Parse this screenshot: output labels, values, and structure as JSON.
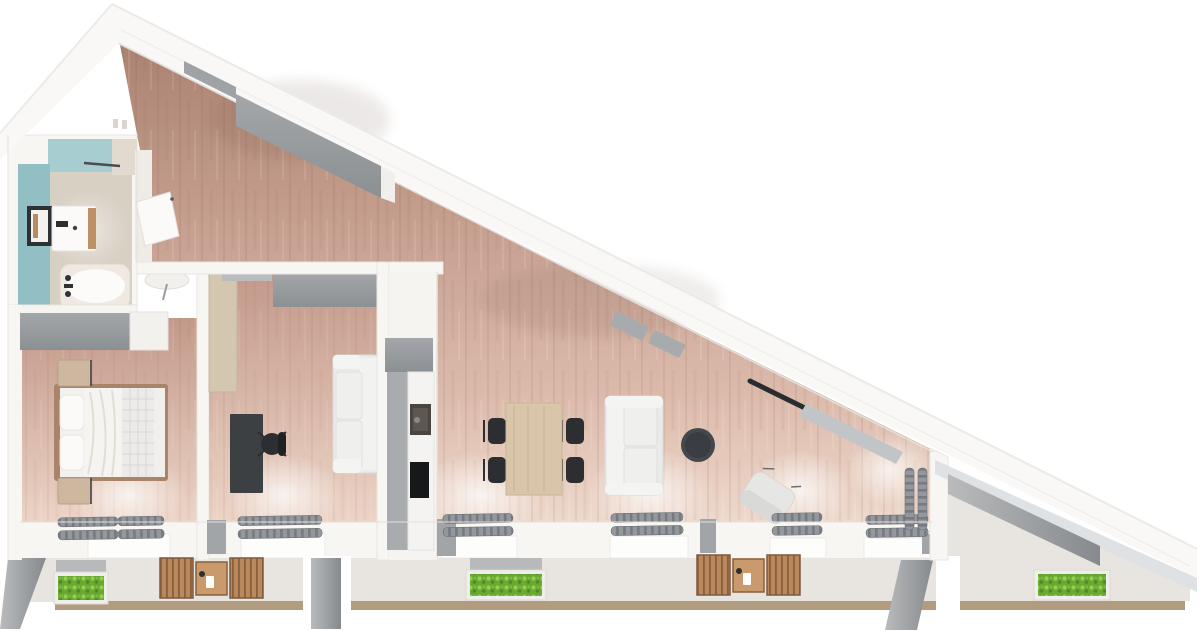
{
  "meta": {
    "kind": "3d-floor-plan-render",
    "view": "top-down",
    "shape": "right-triangle apartment, hypotenuse roof edge from top-left apex to bottom-right tip"
  },
  "colors": {
    "pageBg": "#ffffff",
    "wallWhite": "#f8f6f3",
    "wallEdge": "#e6e3df",
    "tealWallTop": "#a8cdd0",
    "tealWallSide": "#92bfc4",
    "bathFloor": "#d9d0c4",
    "bathEntryFloor": "#e2dacf",
    "furnitureGray": "#989c9f",
    "cabinetGray": "#9aa0a3",
    "stubGray": "#a2a5a7",
    "balconyFloor": "#e8e5e0",
    "balconyEdgeTan": "#b29c80",
    "plantGreen": "#6aa834",
    "patioWood": "#b9885c",
    "patioTableWood": "#c89a6c",
    "sofaWhite": "#eaeaea",
    "sofaShade": "#dcdcdc",
    "deskBlack": "#3c4043",
    "chairBlack": "#2c2e31",
    "diningWood": "#d8c5aa",
    "coffeeTableDark": "#45484d",
    "doorTan": "#d3c7b0",
    "doorWhite": "#fbfaf8",
    "bedFrame": "#a9846b",
    "beddingWhite": "#f6f4f1",
    "quiltGray": "#ecebe9",
    "nightstandTan": "#cdb79e",
    "radiatorGray": "#90959a",
    "mirrorBlack": "#2e3134",
    "applianceWhite": "#fbfaf9",
    "glassStrip": "#dfe2e4",
    "counterWhite": "#f4f3f1",
    "sinkDark": "#4a4540",
    "cooktopBlack": "#17181a"
  },
  "rooms": [
    {
      "name": "hallway",
      "furniture": [
        "sloped-wall-wardrobe",
        "console-table",
        "bathroom-door-open"
      ]
    },
    {
      "name": "bathroom",
      "furniture": [
        "bathtub",
        "washing-machine",
        "vanity-unit",
        "wall-mirror",
        "towel-rail"
      ]
    },
    {
      "name": "bedroom",
      "furniture": [
        "double-bed",
        "nightstand-top",
        "nightstand-bottom",
        "wardrobe",
        "dresser",
        "radiator"
      ]
    },
    {
      "name": "study",
      "furniture": [
        "desk",
        "office-chair",
        "two-seat-sofa",
        "wall-cabinet",
        "open-door",
        "radiator"
      ]
    },
    {
      "name": "kitchen",
      "furniture": [
        "upper-cabinet",
        "counter-run",
        "sink",
        "cooktop"
      ]
    },
    {
      "name": "living-dining",
      "furniture": [
        "dining-table",
        "dining-chair x4",
        "white-sofa",
        "round-coffee-table",
        "armchair",
        "roof-windows",
        "radiator x4",
        "corner-radiator"
      ]
    },
    {
      "name": "balcony-left",
      "furniture": [
        "planter",
        "patio-set"
      ]
    },
    {
      "name": "balcony-middle",
      "furniture": [
        "planter",
        "patio-set"
      ]
    },
    {
      "name": "balcony-right",
      "furniture": [
        "planter"
      ]
    }
  ]
}
